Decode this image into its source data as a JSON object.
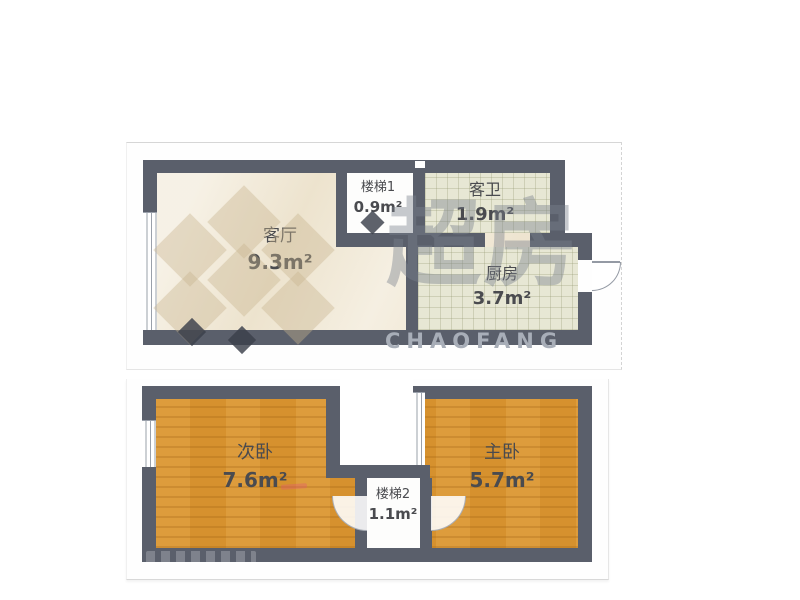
{
  "floors": [
    {
      "id": "upper-level",
      "rooms": [
        {
          "name": "客厅",
          "area": "9.3m²"
        },
        {
          "name": "楼梯1",
          "area": "0.9m²"
        },
        {
          "name": "客卫",
          "area": "1.9m²"
        },
        {
          "name": "厨房",
          "area": "3.7m²"
        }
      ]
    },
    {
      "id": "lower-level",
      "rooms": [
        {
          "name": "次卧",
          "area": "7.6m²"
        },
        {
          "name": "楼梯2",
          "area": "1.1m²"
        },
        {
          "name": "主卧",
          "area": "5.7m²"
        }
      ]
    }
  ],
  "watermark": {
    "logo_text": "超房",
    "brand_text": "CHAOFANG"
  },
  "colors": {
    "wall": "#5a5f6b",
    "marble_floor": "#f2ead8",
    "tile_floor": "#e7e7d4",
    "wood_floor": "#d6912e",
    "label_text": "#4a4b4f",
    "watermark_gray": "#a8aeb8"
  }
}
